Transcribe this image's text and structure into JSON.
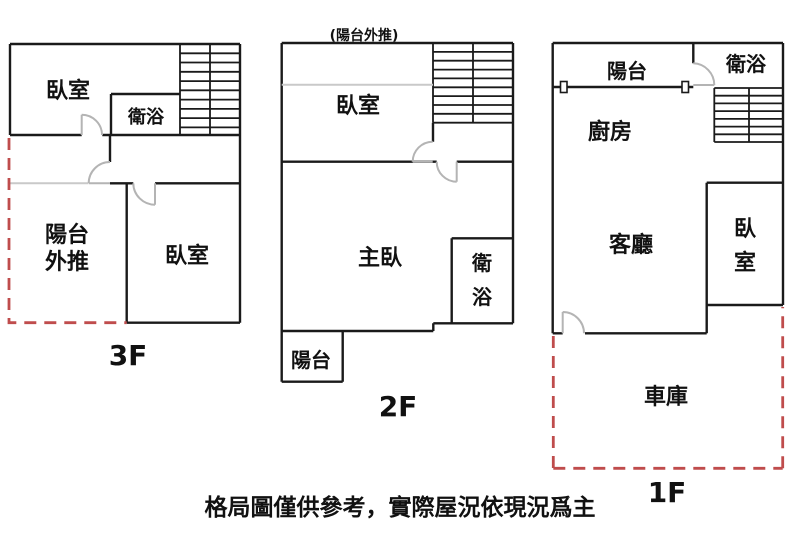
{
  "caption": "格局圖僅供參考，實際屋況依現況爲主",
  "colors": {
    "bg": "#ffffff",
    "wall": "#1a1a1a",
    "door": "#b4b4b4",
    "removed_wall": "#c9c9c9",
    "dashed": "#bf4c4c",
    "text": "#111111"
  },
  "floor_3f": {
    "label": "3F",
    "bedroom_top": "臥室",
    "bathroom": "衛浴",
    "balcony_pushed_line1": "陽台",
    "balcony_pushed_line2": "外推",
    "bedroom_bottom": "臥室"
  },
  "floor_2f": {
    "label": "2F",
    "note": "(陽台外推)",
    "bedroom": "臥室",
    "master_bedroom": "主臥",
    "bathroom": "衛浴",
    "balcony": "陽台"
  },
  "floor_1f": {
    "label": "1F",
    "balcony": "陽台",
    "bathroom": "衛浴",
    "kitchen": "廚房",
    "living_room": "客廳",
    "bedroom": "臥室",
    "garage": "車庫"
  }
}
